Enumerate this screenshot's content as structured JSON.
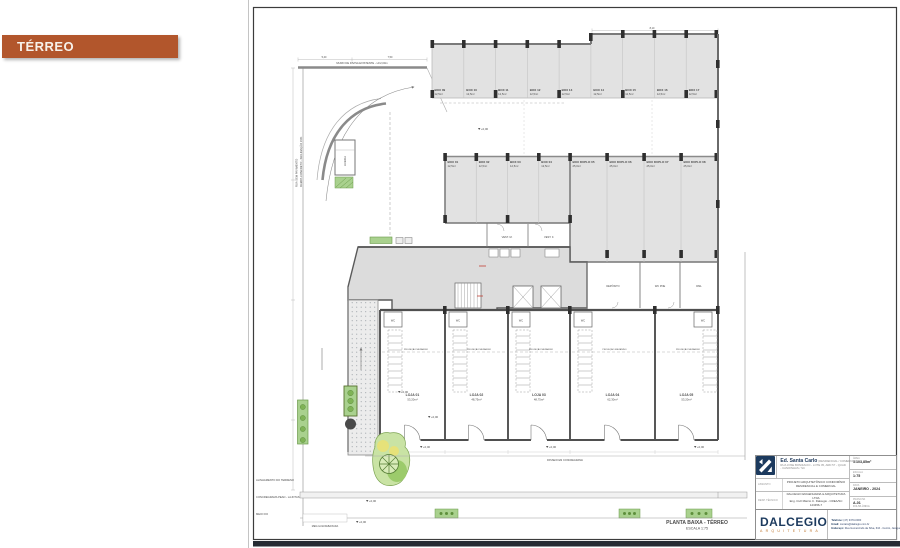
{
  "slide": {
    "section_label": "TÉRREO",
    "accent_color": "#B2562C"
  },
  "plan": {
    "title": "PLANTA BAIXA - TÉRREO",
    "scale": "ESCALA 1:75",
    "level_zero": "+0,00",
    "wall_note": "MURO DE DIVISA EXISTENTE - H=2,00m",
    "street_label_1": "RUA SEM PAVIMENTO",
    "street_label_2": "RAMPA CONCRETO - INCLINAÇÃO 15%",
    "trash_label": "LIXEIRA",
    "mezzanine_note": "PROJEÇÃO MEZANINO",
    "wc_label": "WC",
    "sidewalk_note": "PASSEIO EM CONCREGRAMA",
    "curb_note": "MEIA GUIA REBAIXADA",
    "dims_top": [
      "5,40",
      "7,50",
      "8,10"
    ],
    "margin_notes": [
      "ALINHAMENTO DO TERRENO",
      "CONCREGRAMA PEAD - LAJOTAS GRAMADAS",
      "MEIO FIO"
    ],
    "boxes_top": [
      {
        "label": "BOX 09",
        "area": "12,5m²"
      },
      {
        "label": "BOX 10",
        "area": "12,5m²"
      },
      {
        "label": "BOX 11",
        "area": "12,5m²"
      },
      {
        "label": "BOX 12",
        "area": "12,5m²"
      },
      {
        "label": "BOX 13",
        "area": "12,5m²"
      },
      {
        "label": "BOX 14",
        "area": "12,5m²"
      },
      {
        "label": "BOX 15",
        "area": "12,5m²"
      },
      {
        "label": "BOX 16",
        "area": "12,5m²"
      },
      {
        "label": "BOX 17",
        "area": "12,5m²"
      }
    ],
    "boxes_left": [
      {
        "label": "BOX 01",
        "area": "12,5m²"
      },
      {
        "label": "BOX 02",
        "area": "12,5m²"
      },
      {
        "label": "BOX 03",
        "area": "12,5m²"
      },
      {
        "label": "BOX 04",
        "area": "12,5m²"
      }
    ],
    "boxes_double": [
      {
        "label": "BOX DUPLO 05",
        "area": "25,0m²"
      },
      {
        "label": "BOX DUPLO 06",
        "area": "25,0m²"
      },
      {
        "label": "BOX DUPLO 07",
        "area": "25,0m²"
      },
      {
        "label": "BOX DUPLO 08",
        "area": "25,0m²"
      }
    ],
    "rooms_vest": [
      "VEST. M.",
      "VEST. F."
    ],
    "rooms_service": [
      "DEPÓSITO",
      "WC PNE",
      "DML"
    ],
    "lojas": [
      {
        "label": "LOJA 01",
        "area": "53,20m²"
      },
      {
        "label": "LOJA 02",
        "area": "48,75m²"
      },
      {
        "label": "LOJA 03",
        "area": "48,75m²"
      },
      {
        "label": "LOJA 04",
        "area": "62,30m²"
      },
      {
        "label": "LOJA 05",
        "area": "53,20m²"
      }
    ]
  },
  "titleblock": {
    "client": {
      "logo_top": "SANTA",
      "logo_bottom": "CARLO",
      "name": "Ed. Santa Carlo",
      "type": "(RESIDENCIAL / COMERCIAL)",
      "address": "RUA JOSÉ BONIFÁCIO - LOTE 05, ARD 57 - QUADRA 52",
      "address2": "- CANOINHAS / SC"
    },
    "rows": [
      {
        "label": "ASSUNTO",
        "value": "PROJETO ARQUITETÔNICO CONDOMÍNIO RESIDENCIAL E COMERCIAL"
      },
      {
        "label": "RESP. TÉCNICO",
        "value": "DALCEGIO ENGENHARIA & ARQUITETURA LTDA",
        "value2": "Eng. Civil Márcio C. Dalcegio - CREA/SC 123456-7"
      }
    ],
    "fields": [
      {
        "label": "ÁREA",
        "value": "1.103,85m²"
      },
      {
        "label": "ESCALA",
        "value": "1:75"
      },
      {
        "label": "DATA",
        "value": "JANEIRO - 2024"
      },
      {
        "label": "PRANCHA",
        "value": "A-01",
        "extra": "FOLHA ÚNICA"
      }
    ],
    "firm": {
      "name": "DALCEGIO",
      "tagline": "ARQUITETURA"
    },
    "contact": [
      {
        "label": "Telefone:",
        "value": "(47) 3370-0000"
      },
      {
        "label": "Email:",
        "value": "contato@dalcegio.com.br"
      },
      {
        "label": "Endereço:",
        "value": "Rua Gumercindo da Silva, 616 - Centro, Jaraguá do Sul - SC"
      }
    ]
  }
}
